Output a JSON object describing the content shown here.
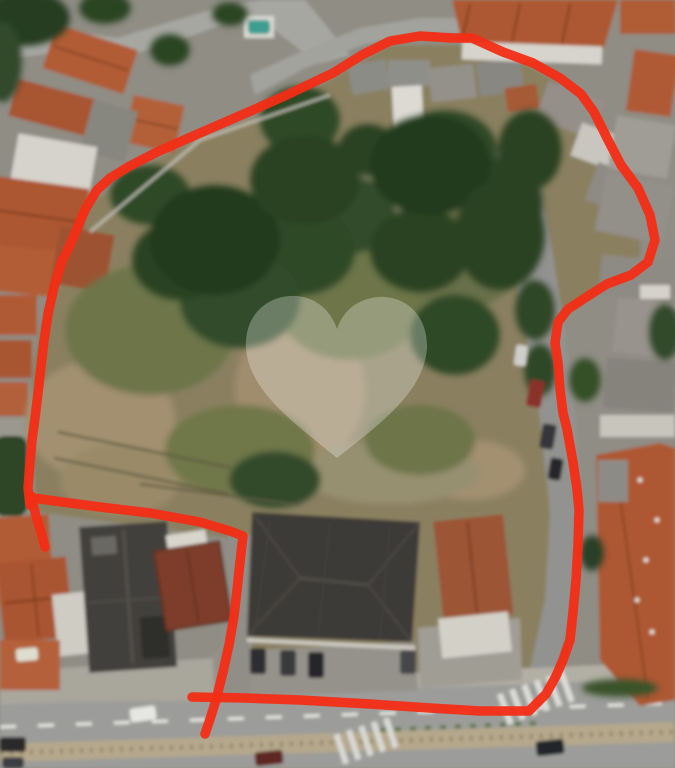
{
  "image": {
    "kind": "aerial-satellite-photo",
    "subject": "urban vacant land parcel outlined in red",
    "width": 675,
    "height": 768
  },
  "annotation": {
    "color": "#f32d15",
    "stroke_width": 9.5,
    "opacity": 0.95,
    "paths": [
      [
        [
          30,
          505
        ],
        [
          28,
          488
        ],
        [
          30,
          462
        ],
        [
          32,
          440
        ],
        [
          35,
          418
        ],
        [
          38,
          393
        ],
        [
          41,
          367
        ],
        [
          44,
          341
        ],
        [
          48,
          314
        ],
        [
          54,
          287
        ],
        [
          62,
          261
        ],
        [
          70,
          245
        ],
        [
          78,
          226
        ],
        [
          86,
          208
        ],
        [
          97,
          190
        ],
        [
          110,
          178
        ],
        [
          128,
          167
        ],
        [
          157,
          152
        ],
        [
          200,
          133
        ],
        [
          253,
          110
        ],
        [
          291,
          93
        ],
        [
          333,
          73
        ],
        [
          362,
          55
        ],
        [
          390,
          41
        ],
        [
          420,
          36
        ],
        [
          452,
          38
        ],
        [
          472,
          38
        ],
        [
          503,
          52
        ],
        [
          533,
          63
        ],
        [
          560,
          78
        ],
        [
          581,
          94
        ],
        [
          594,
          112
        ],
        [
          608,
          140
        ],
        [
          621,
          165
        ],
        [
          638,
          188
        ],
        [
          650,
          215
        ],
        [
          655,
          240
        ],
        [
          648,
          262
        ],
        [
          631,
          275
        ],
        [
          607,
          284
        ],
        [
          588,
          296
        ],
        [
          568,
          309
        ],
        [
          558,
          322
        ],
        [
          555,
          343
        ],
        [
          558,
          363
        ],
        [
          560,
          389
        ],
        [
          563,
          413
        ],
        [
          567,
          429
        ],
        [
          573,
          462
        ],
        [
          577,
          489
        ],
        [
          579,
          510
        ],
        [
          578,
          545
        ],
        [
          576,
          580
        ],
        [
          573,
          612
        ],
        [
          570,
          640
        ],
        [
          563,
          660
        ],
        [
          556,
          676
        ],
        [
          546,
          694
        ],
        [
          529,
          711
        ],
        [
          480,
          711
        ],
        [
          430,
          708
        ],
        [
          370,
          704
        ],
        [
          300,
          700
        ],
        [
          245,
          698
        ],
        [
          192,
          697
        ]
      ],
      [
        [
          33,
          498
        ],
        [
          62,
          502
        ],
        [
          100,
          507
        ],
        [
          150,
          513
        ],
        [
          200,
          522
        ],
        [
          230,
          531
        ],
        [
          243,
          536
        ],
        [
          240,
          562
        ],
        [
          237,
          590
        ],
        [
          234,
          616
        ],
        [
          229,
          645
        ],
        [
          223,
          672
        ],
        [
          216,
          700
        ],
        [
          211,
          716
        ],
        [
          205,
          734
        ]
      ],
      [
        [
          31,
          496
        ],
        [
          36,
          516
        ],
        [
          41,
          532
        ],
        [
          45,
          547
        ]
      ]
    ]
  },
  "watermark": {
    "color": "#ffffff",
    "opacity": 0.28,
    "circle": {
      "cx": 381,
      "cy": 352,
      "r": 44
    },
    "heart_path": "M337 458 C296 424 249 392 246 348 C244 313 270 294 297 296 C317 298 331 311 337 329 C343 311 357 299 378 297 C404 295 428 314 427 348 C424 392 380 424 337 458 Z"
  },
  "palette": {
    "lot_base": "#8a8060",
    "road": "#9c9c9a",
    "road_top": "#a7a7a2",
    "street": "#929290",
    "sidewalk": "#b2afa4",
    "median": "#b5a88c",
    "roof_terracotta": "#ad5833",
    "roof_dark": "#3c3b38",
    "roof_maroon": "#7d3c2b",
    "wall_white": "#d6d4cc",
    "tree_dark": "#2b4222",
    "pool_teal": "#3e9e90"
  }
}
